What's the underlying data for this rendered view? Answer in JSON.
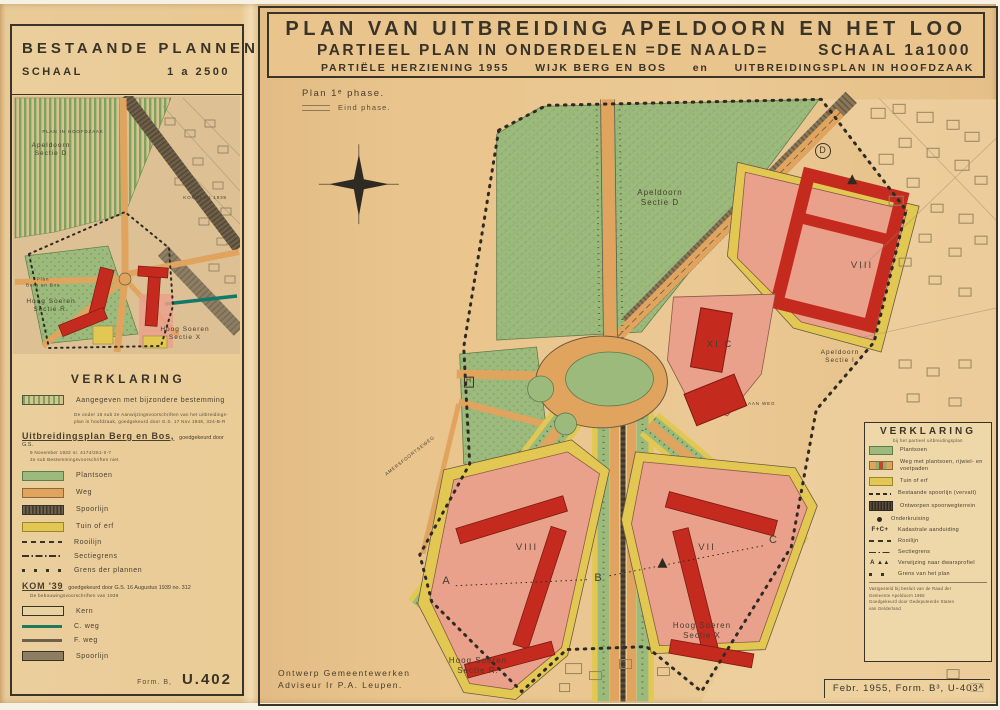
{
  "left_panel": {
    "title": "BESTAANDE PLANNEN",
    "scale_label": "SCHAAL",
    "scale_value": "1 a 2500",
    "map_labels": {
      "plan_in_hoofdzaak": "PLAN IN HOOFDZAAK",
      "sectie_top_line1": "Apeldoorn",
      "sectie_top_line2": "Sectie D",
      "komplan": "KOMPLAN 1939",
      "plan_left_line1": "Plan",
      "plan_left_line2": "Berg en Bos",
      "hoog_soeren_r_line1": "Hoog Soeren",
      "hoog_soeren_r_line2": "Sectie R.",
      "hoog_soeren_x_line1": "Hoog Soeren",
      "hoog_soeren_x_line2": "Sectie X"
    },
    "legend": {
      "title": "VERKLARING",
      "item1_label": "Aangegeven met bijzondere bestemming",
      "item1_note1": "De onder 15 sub 2e Aanwijzingsvoorschriften van het uitbreidings-",
      "item1_note2": "plan in hoofdzaak, goedgekeurd door G.S. 17 Nov 1948, 324-B-R",
      "berg_en_bos_title": "Uitbreidingsplan Berg en Bos,",
      "berg_en_bos_suffix": "goedgekeurd door G.S.",
      "berg_en_bos_note1": "9 November 1932 nr. 4174/281-II-7",
      "berg_en_bos_note2": "2e sub Bestemmingsvoorschriften niet",
      "plantsoen": "Plantsoen",
      "weg": "Weg",
      "spoorlijn1": "Spoorlijn",
      "tuin": "Tuin of erf",
      "rooilijn": "Rooilijn",
      "sectiegrens": "Sectiegrens",
      "grens": "Grens der plannen",
      "kom_title": "KOM '39",
      "kom_suffix": "goedgekeurd door G.S. 16 Augustus 1939 no. 312",
      "kom_note": "De bebouwingsvoorschriften van 1939",
      "kern": "Kern",
      "cweg": "C. weg",
      "fweg": "F. weg",
      "spoorlijn2": "Spoorlijn"
    },
    "form_label": "Form. B,",
    "form_number": "U.402"
  },
  "right_panel": {
    "title_line1": "PLAN VAN UITBREIDING APELDOORN EN HET LOO",
    "title_line2_left": "PARTIEEL PLAN IN ONDERDELEN =DE NAALD=",
    "title_line2_right": "SCHAAL 1a1000",
    "title_line3_a": "PARTIËLE HERZIENING 1955",
    "title_line3_b": "WIJK BERG EN BOS",
    "title_line3_c": "en",
    "title_line3_d": "UITBREIDINGSPLAN IN HOOFDZAAK",
    "phase1": "Plan 1ᵉ phase.",
    "phase_end": "Eind phase.",
    "map_labels": {
      "sectie_d_line1": "Apeldoorn",
      "sectie_d_line2": "Sectie D",
      "sectie_i_line1": "Apeldoorn",
      "sectie_i_line2": "Sectie I",
      "hoog_soeren_r_line1": "Hoog Soeren",
      "hoog_soeren_r_line2": "Sectie R.",
      "hoog_soeren_x_line1": "Hoog Soeren",
      "hoog_soeren_x_line2": "Sectie X",
      "block_viii_ne": "VIII",
      "block_xic": "XI C",
      "block_viii_sw": "VIII",
      "block_vii": "VII",
      "marker_a": "A",
      "marker_b": "B",
      "marker_c": "C",
      "marker_d": "D",
      "marker_h": "H",
      "street_1": "LAAN WEG",
      "street_2": "AMERSFOORTSEWEG"
    },
    "legend": {
      "title": "VERKLARING",
      "subtitle": "bij het partieel uitbreidingsplan",
      "plantsoen": "Plantsoen",
      "weg_met": "Weg met plantsoen, rijwiel- en voetpaden",
      "tuin": "Tuin of erf",
      "best_spoor": "Bestaande spoorlijn (vervalt)",
      "ontworpen": "Ontworpen spoorwegterrein",
      "onderkruising": "Onderkruising",
      "kadaster_glyph": "F+C+",
      "kadaster": "Kadastrale aanduiding",
      "rooilijn": "Rooilijn",
      "sectiegrens": "Sectiegrens",
      "profiel_glyph": "A ▲▲",
      "profiel": "Verwijzing naar dwarsprofiel",
      "grens": "Grens van het plan",
      "note1": "Vastgesteld bij besluit van de Raad der",
      "note2": "Gemeente Apeldoorn 1955",
      "note3": "Goedgekeurd door Gedeputeerde Staten",
      "note4": "van Gelderland"
    },
    "credits_line1": "Ontwerp Gemeentewerken",
    "credits_line2": "Adviseur Ir P.A. Leupen.",
    "form_number": "Febr. 1955, Form. B³, U-403ᴬ"
  }
}
